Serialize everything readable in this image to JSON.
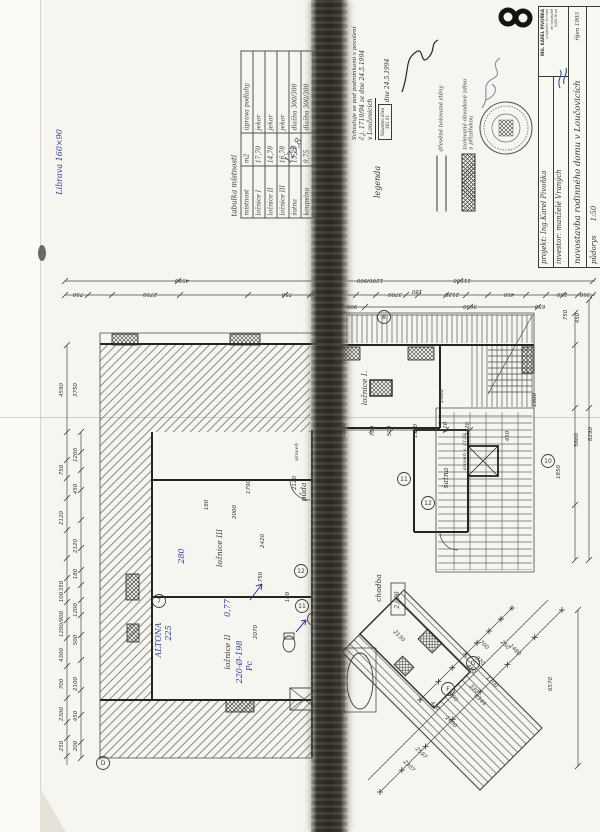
{
  "page": {
    "number_mark": "8"
  },
  "notes": {
    "top_left": "Librava 160×90",
    "table_sum": "123,8"
  },
  "room_table": {
    "title": "tabulka místností",
    "headers": [
      "místnost",
      "m2",
      "úprava podlahy"
    ],
    "rows": [
      [
        "ložnice I",
        "17,70",
        "jekor"
      ],
      [
        "ložnice II",
        "14,78",
        "jekor"
      ],
      [
        "ložnice III",
        "16,78",
        "jekor"
      ],
      [
        "šatna",
        "13,25",
        "dlažba 300/300"
      ],
      [
        "koupelna",
        "9,75",
        "dlažba 300/300"
      ],
      [
        "chodba",
        "24,60",
        "dlažba 300/300"
      ],
      [
        "půda",
        "26,70",
        "beton. mazanina"
      ]
    ]
  },
  "approval": {
    "line1": "Schvaluje se pod podmínkami v povolení",
    "line2": "č.j. 1719/94 ze dne 24.5.1994",
    "line3": "v Loučovicích",
    "line4": "dne 24.5.1994",
    "stamp_line1": "Stavební úřad",
    "stamp_line2": "381 01"
  },
  "legend": {
    "title": "legenda",
    "items": [
      {
        "label": "dřevěné bolované stěny"
      },
      {
        "label1": "izolované obvodové zdivo",
        "label2": "s přizdívkou"
      }
    ]
  },
  "title_block": {
    "project_label": "projekt:",
    "project": "Ing.Karel Pivoňka",
    "investor_label": "investor:",
    "investor": "manželé Vraných",
    "office_line1": "ING. KAREL PIVOŇKA",
    "office_line2": "projekční činnost",
    "office_line3": "ve výstavbě",
    "office_line4": "Vyšší Brod",
    "title": "novostavba rodinného domu v Loučovicích",
    "date": "říjen 1993",
    "drawing": "půdorys",
    "scale": "1:50"
  },
  "plan": {
    "rooms": [
      {
        "t": "ložnice I.",
        "x": 367,
        "y": 388,
        "r": -90
      },
      {
        "t": "půda",
        "x": 306,
        "y": 492,
        "r": -90
      },
      {
        "t": "šatna",
        "x": 448,
        "y": 478,
        "r": -90
      },
      {
        "t": "ložnice III",
        "x": 222,
        "y": 548,
        "r": -90
      },
      {
        "t": "ložnice II",
        "x": 230,
        "y": 652,
        "r": -90
      },
      {
        "t": "koupelna",
        "x": 341,
        "y": 692,
        "r": -90
      },
      {
        "t": "chodba",
        "x": 381,
        "y": 588,
        "r": -90
      },
      {
        "t": "úroveň",
        "x": 298,
        "y": 452,
        "r": -90,
        "cls": "small"
      },
      {
        "t": "úroveň v. 2120",
        "x": 466,
        "y": 452,
        "r": -90,
        "cls": "small"
      },
      {
        "t": "2,690",
        "x": 399,
        "y": 600,
        "r": -90,
        "cls": "boxed"
      }
    ],
    "dims": [
      {
        "t": "11500",
        "x": 462,
        "y": 279,
        "r": 180
      },
      {
        "t": "4590",
        "x": 182,
        "y": 279,
        "r": 180
      },
      {
        "t": "750",
        "x": 78,
        "y": 293,
        "r": 180
      },
      {
        "t": "2750",
        "x": 150,
        "y": 293,
        "r": 180
      },
      {
        "t": "750",
        "x": 287,
        "y": 293,
        "r": 180
      },
      {
        "t": "500",
        "x": 315,
        "y": 293,
        "r": 180
      },
      {
        "t": "1200/900",
        "x": 370,
        "y": 279,
        "r": 180
      },
      {
        "t": "900",
        "x": 352,
        "y": 305,
        "r": 180
      },
      {
        "t": "3700",
        "x": 395,
        "y": 293,
        "r": 180
      },
      {
        "t": "180",
        "x": 417,
        "y": 290,
        "r": 180
      },
      {
        "t": "2120",
        "x": 452,
        "y": 293,
        "r": 180
      },
      {
        "t": "3650",
        "x": 470,
        "y": 305,
        "r": 180
      },
      {
        "t": "450",
        "x": 509,
        "y": 293,
        "r": 180
      },
      {
        "t": "650",
        "x": 540,
        "y": 305,
        "r": 180
      },
      {
        "t": "250",
        "x": 562,
        "y": 293,
        "r": 180
      },
      {
        "t": "350",
        "x": 585,
        "y": 293,
        "r": 180
      },
      {
        "t": "4590",
        "x": 63,
        "y": 390,
        "r": -90
      },
      {
        "t": "3750",
        "x": 77,
        "y": 390,
        "r": -90
      },
      {
        "t": "1200",
        "x": 77,
        "y": 455,
        "r": -90
      },
      {
        "t": "750",
        "x": 63,
        "y": 470,
        "r": -90
      },
      {
        "t": "450",
        "x": 77,
        "y": 489,
        "r": -90
      },
      {
        "t": "2120",
        "x": 63,
        "y": 518,
        "r": -90
      },
      {
        "t": "2120",
        "x": 77,
        "y": 546,
        "r": -90
      },
      {
        "t": "180",
        "x": 77,
        "y": 574,
        "r": -90
      },
      {
        "t": "350",
        "x": 63,
        "y": 586,
        "r": -90
      },
      {
        "t": "100",
        "x": 63,
        "y": 597,
        "r": -90
      },
      {
        "t": "1200",
        "x": 77,
        "y": 610,
        "r": -90
      },
      {
        "t": "1200/900",
        "x": 63,
        "y": 624,
        "r": -90
      },
      {
        "t": "500",
        "x": 77,
        "y": 640,
        "r": -90
      },
      {
        "t": "4300",
        "x": 63,
        "y": 655,
        "r": -90
      },
      {
        "t": "700",
        "x": 63,
        "y": 684,
        "r": -90
      },
      {
        "t": "2100",
        "x": 77,
        "y": 684,
        "r": -90
      },
      {
        "t": "2300",
        "x": 63,
        "y": 714,
        "r": -90
      },
      {
        "t": "450",
        "x": 77,
        "y": 716,
        "r": -90
      },
      {
        "t": "250",
        "x": 63,
        "y": 746,
        "r": -90
      },
      {
        "t": "200",
        "x": 77,
        "y": 746,
        "r": -90
      },
      {
        "t": "750",
        "x": 567,
        "y": 315,
        "r": -90
      },
      {
        "t": "450",
        "x": 579,
        "y": 318,
        "r": -90
      },
      {
        "t": "6290",
        "x": 592,
        "y": 434,
        "r": -90
      },
      {
        "t": "5600",
        "x": 578,
        "y": 440,
        "r": -90
      },
      {
        "t": "1800",
        "x": 536,
        "y": 400,
        "r": -90
      },
      {
        "t": "1850",
        "x": 560,
        "y": 472,
        "r": -90
      },
      {
        "t": "6570",
        "x": 552,
        "y": 684,
        "r": -90
      },
      {
        "t": "1850",
        "x": 345,
        "y": 430,
        "r": -90
      },
      {
        "t": "700",
        "x": 374,
        "y": 431,
        "r": -90
      },
      {
        "t": "500",
        "x": 391,
        "y": 431,
        "r": -90
      },
      {
        "t": "1550",
        "x": 417,
        "y": 431,
        "r": -90
      },
      {
        "t": "810",
        "x": 447,
        "y": 427,
        "r": -90
      },
      {
        "t": "2120",
        "x": 469,
        "y": 429,
        "r": -90
      },
      {
        "t": "1800",
        "x": 443,
        "y": 396,
        "r": -90
      },
      {
        "t": "450",
        "x": 509,
        "y": 436,
        "r": -90
      },
      {
        "t": "1790",
        "x": 250,
        "y": 487,
        "r": -90
      },
      {
        "t": "2000",
        "x": 236,
        "y": 512,
        "r": -90
      },
      {
        "t": "180",
        "x": 208,
        "y": 505,
        "r": -90
      },
      {
        "t": "2120",
        "x": 296,
        "y": 483,
        "r": -90
      },
      {
        "t": "2420",
        "x": 264,
        "y": 541,
        "r": -90
      },
      {
        "t": "750",
        "x": 262,
        "y": 577,
        "r": -90
      },
      {
        "t": "180",
        "x": 289,
        "y": 597,
        "r": -90
      },
      {
        "t": "2070",
        "x": 257,
        "y": 632,
        "r": -90
      },
      {
        "t": "2200",
        "x": 325,
        "y": 601,
        "r": 180
      },
      {
        "t": "2130",
        "x": 398,
        "y": 637,
        "r": 45
      },
      {
        "t": "8344",
        "x": 479,
        "y": 701,
        "r": 45
      },
      {
        "t": "2597",
        "x": 420,
        "y": 754,
        "r": 45
      },
      {
        "t": "2307",
        "x": 408,
        "y": 767,
        "r": 45
      },
      {
        "t": "1400",
        "x": 450,
        "y": 723,
        "r": 45
      },
      {
        "t": "1480",
        "x": 514,
        "y": 651,
        "r": 45
      },
      {
        "t": "700",
        "x": 483,
        "y": 646,
        "r": 45
      },
      {
        "t": "250",
        "x": 504,
        "y": 646,
        "r": 45
      },
      {
        "t": "900",
        "x": 452,
        "y": 698,
        "r": 45
      },
      {
        "t": "450",
        "x": 470,
        "y": 670,
        "r": 45
      },
      {
        "t": "920",
        "x": 479,
        "y": 662,
        "r": 45
      },
      {
        "t": "330",
        "x": 473,
        "y": 690,
        "r": 45
      },
      {
        "t": "1700",
        "x": 491,
        "y": 683,
        "r": 45
      },
      {
        "t": "420",
        "x": 434,
        "y": 707,
        "r": 45
      }
    ],
    "axis_markers": [
      {
        "t": "8",
        "x": 384,
        "y": 317
      },
      {
        "t": "7",
        "x": 159,
        "y": 601
      },
      {
        "t": "10",
        "x": 548,
        "y": 461
      },
      {
        "t": "12",
        "x": 301,
        "y": 571
      },
      {
        "t": "11",
        "x": 302,
        "y": 606
      },
      {
        "t": "10",
        "x": 314,
        "y": 619
      },
      {
        "t": "11",
        "x": 404,
        "y": 479
      },
      {
        "t": "12",
        "x": 428,
        "y": 503
      },
      {
        "t": "G",
        "x": 473,
        "y": 663
      },
      {
        "t": "F",
        "x": 448,
        "y": 689
      },
      {
        "t": "D",
        "x": 103,
        "y": 763
      }
    ],
    "blue_notes": [
      {
        "t": "Librava 160×90",
        "x": 62,
        "y": 162,
        "r": -90
      },
      {
        "t": "123,8",
        "x": 296,
        "y": 152,
        "r": -62,
        "cls": "dark"
      },
      {
        "t": "280",
        "x": 184,
        "y": 556,
        "r": -90
      },
      {
        "t": "0,77",
        "x": 230,
        "y": 608,
        "r": -90
      },
      {
        "t": "ALTONA",
        "x": 161,
        "y": 640,
        "r": -90
      },
      {
        "t": "225",
        "x": 171,
        "y": 633,
        "r": -90
      },
      {
        "t": "220-Ø-198",
        "x": 242,
        "y": 662,
        "r": -90
      },
      {
        "t": "Pc",
        "x": 252,
        "y": 666,
        "r": -90
      }
    ]
  }
}
